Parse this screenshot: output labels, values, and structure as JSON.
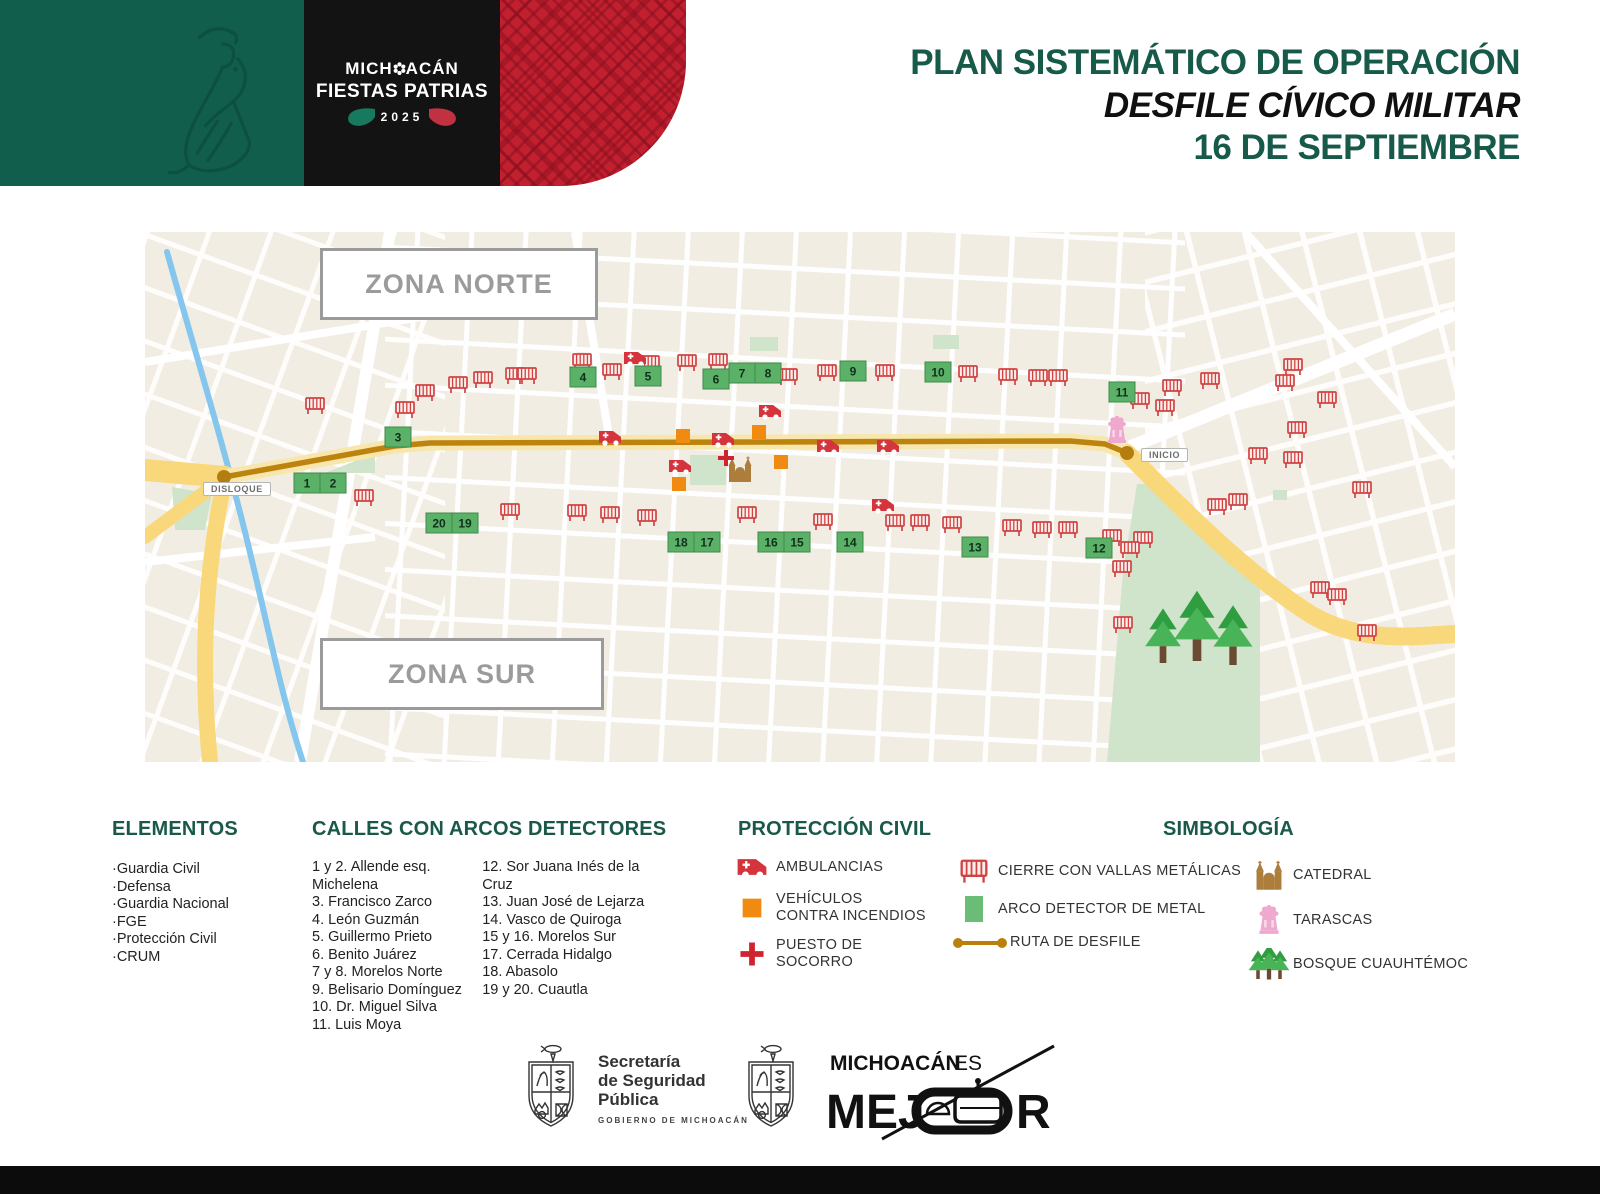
{
  "header": {
    "brand_pre": "MICH",
    "brand_post": "ACÁN",
    "brand_line2": "FIESTAS PATRIAS",
    "brand_year": "2025",
    "title_line1": "PLAN SISTEMÁTICO DE OPERACIÓN",
    "title_line2": "DESFILE CÍVICO MILITAR",
    "title_line3": "16 DE SEPTIEMBRE"
  },
  "map": {
    "zone_north_label": "ZONA NORTE",
    "zone_south_label": "ZONA SUR",
    "start_label": "DISLOQUE",
    "end_label": "INICIO",
    "arcos": [
      {
        "n": "1",
        "x": 162,
        "y": 251
      },
      {
        "n": "2",
        "x": 188,
        "y": 251
      },
      {
        "n": "3",
        "x": 253,
        "y": 205
      },
      {
        "n": "4",
        "x": 438,
        "y": 145
      },
      {
        "n": "5",
        "x": 503,
        "y": 144
      },
      {
        "n": "6",
        "x": 571,
        "y": 147
      },
      {
        "n": "7",
        "x": 597,
        "y": 141
      },
      {
        "n": "8",
        "x": 623,
        "y": 141
      },
      {
        "n": "9",
        "x": 708,
        "y": 139
      },
      {
        "n": "10",
        "x": 793,
        "y": 140
      },
      {
        "n": "11",
        "x": 977,
        "y": 160
      },
      {
        "n": "12",
        "x": 954,
        "y": 316
      },
      {
        "n": "13",
        "x": 830,
        "y": 315
      },
      {
        "n": "14",
        "x": 705,
        "y": 310
      },
      {
        "n": "15",
        "x": 652,
        "y": 310
      },
      {
        "n": "16",
        "x": 626,
        "y": 310
      },
      {
        "n": "17",
        "x": 562,
        "y": 310
      },
      {
        "n": "18",
        "x": 536,
        "y": 310
      },
      {
        "n": "19",
        "x": 320,
        "y": 291
      },
      {
        "n": "20",
        "x": 294,
        "y": 291
      }
    ],
    "barriers": [
      [
        170,
        174
      ],
      [
        260,
        178
      ],
      [
        280,
        161
      ],
      [
        313,
        153
      ],
      [
        338,
        148
      ],
      [
        370,
        144
      ],
      [
        382,
        144
      ],
      [
        437,
        130
      ],
      [
        467,
        140
      ],
      [
        505,
        132
      ],
      [
        542,
        131
      ],
      [
        573,
        130
      ],
      [
        643,
        145
      ],
      [
        682,
        141
      ],
      [
        740,
        141
      ],
      [
        823,
        142
      ],
      [
        863,
        145
      ],
      [
        893,
        146
      ],
      [
        913,
        146
      ],
      [
        995,
        169
      ],
      [
        1020,
        176
      ],
      [
        1027,
        156
      ],
      [
        1065,
        149
      ],
      [
        1148,
        135
      ],
      [
        1140,
        151
      ],
      [
        1182,
        168
      ],
      [
        1152,
        198
      ],
      [
        1113,
        224
      ],
      [
        1148,
        228
      ],
      [
        1217,
        258
      ],
      [
        219,
        266
      ],
      [
        365,
        280
      ],
      [
        432,
        281
      ],
      [
        465,
        283
      ],
      [
        502,
        286
      ],
      [
        602,
        283
      ],
      [
        678,
        290
      ],
      [
        750,
        291
      ],
      [
        775,
        291
      ],
      [
        807,
        293
      ],
      [
        867,
        296
      ],
      [
        897,
        298
      ],
      [
        923,
        298
      ],
      [
        967,
        306
      ],
      [
        998,
        308
      ],
      [
        985,
        318
      ],
      [
        977,
        337
      ],
      [
        978,
        393
      ],
      [
        1072,
        275
      ],
      [
        1093,
        270
      ],
      [
        1175,
        358
      ],
      [
        1192,
        365
      ],
      [
        1222,
        401
      ]
    ],
    "ambulances": [
      [
        490,
        127
      ],
      [
        625,
        180
      ],
      [
        465,
        206
      ],
      [
        578,
        208
      ],
      [
        683,
        215
      ],
      [
        743,
        215
      ],
      [
        535,
        235
      ],
      [
        738,
        274
      ]
    ],
    "fire_vehicles": [
      [
        538,
        204
      ],
      [
        614,
        200
      ],
      [
        636,
        230
      ],
      [
        534,
        252
      ]
    ],
    "aid_posts": [
      [
        581,
        226
      ]
    ]
  },
  "legend": {
    "elementos": {
      "title": "ELEMENTOS",
      "items": [
        "·Guardia Civil",
        "·Defensa",
        "·Guardia Nacional",
        "·FGE",
        "·Protección Civil",
        "·CRUM"
      ]
    },
    "calles": {
      "title": "CALLES CON ARCOS DETECTORES",
      "col1": [
        "1 y 2. Allende esq. Michelena",
        "3. Francisco Zarco",
        "4. León Guzmán",
        "5. Guillermo Prieto",
        "6. Benito Juárez",
        "7 y 8. Morelos Norte",
        "9. Belisario Domínguez",
        "10. Dr. Miguel Silva",
        "11. Luis Moya"
      ],
      "col2": [
        "12. Sor Juana Inés de la Cruz",
        "13. Juan José de Lejarza",
        "14. Vasco de Quiroga",
        "15 y 16. Morelos Sur",
        "17. Cerrada Hidalgo",
        "18. Abasolo",
        "19 y 20. Cuautla"
      ]
    },
    "proteccion": {
      "title": "PROTECCIÓN CIVIL",
      "ambulancias": "AMBULANCIAS",
      "vehiculos_l1": "VEHÍCULOS",
      "vehiculos_l2": "CONTRA INCENDIOS",
      "puesto": "PUESTO DE SOCORRO"
    },
    "simbologia": {
      "title": "SIMBOLOGÍA",
      "cierre": "CIERRE CON VALLAS METÁLICAS",
      "arco": "ARCO DETECTOR DE METAL",
      "ruta": "RUTA DE DESFILE",
      "catedral": "CATEDRAL",
      "tarascas": "TARASCAS",
      "bosque": "BOSQUE CUAUHTÉMOC"
    }
  },
  "footer": {
    "ssp_line1": "Secretaría",
    "ssp_line2": "de Seguridad",
    "ssp_line3": "Pública",
    "ssp_sub": "GOBIERNO DE MICHOACÁN",
    "mejor_line1_bold": "MICHOACÁN",
    "mejor_line1_reg": "ES",
    "mejor_word_pre": "MEJ",
    "mejor_word_post": "R"
  },
  "colors": {
    "header_green": "#115e4d",
    "header_red": "#c2202f",
    "title_green": "#175a4a",
    "route_gold": "#bd830f",
    "arco_green": "#5cb168",
    "barrier_red": "#d04343",
    "fire_orange": "#f08a10",
    "cross_red": "#cf2430",
    "tarascas_pink": "#efa9ce",
    "catedral_brown": "#ad7d3c",
    "park_green": "#cfe4cb",
    "river_blue": "#85c6ee"
  }
}
